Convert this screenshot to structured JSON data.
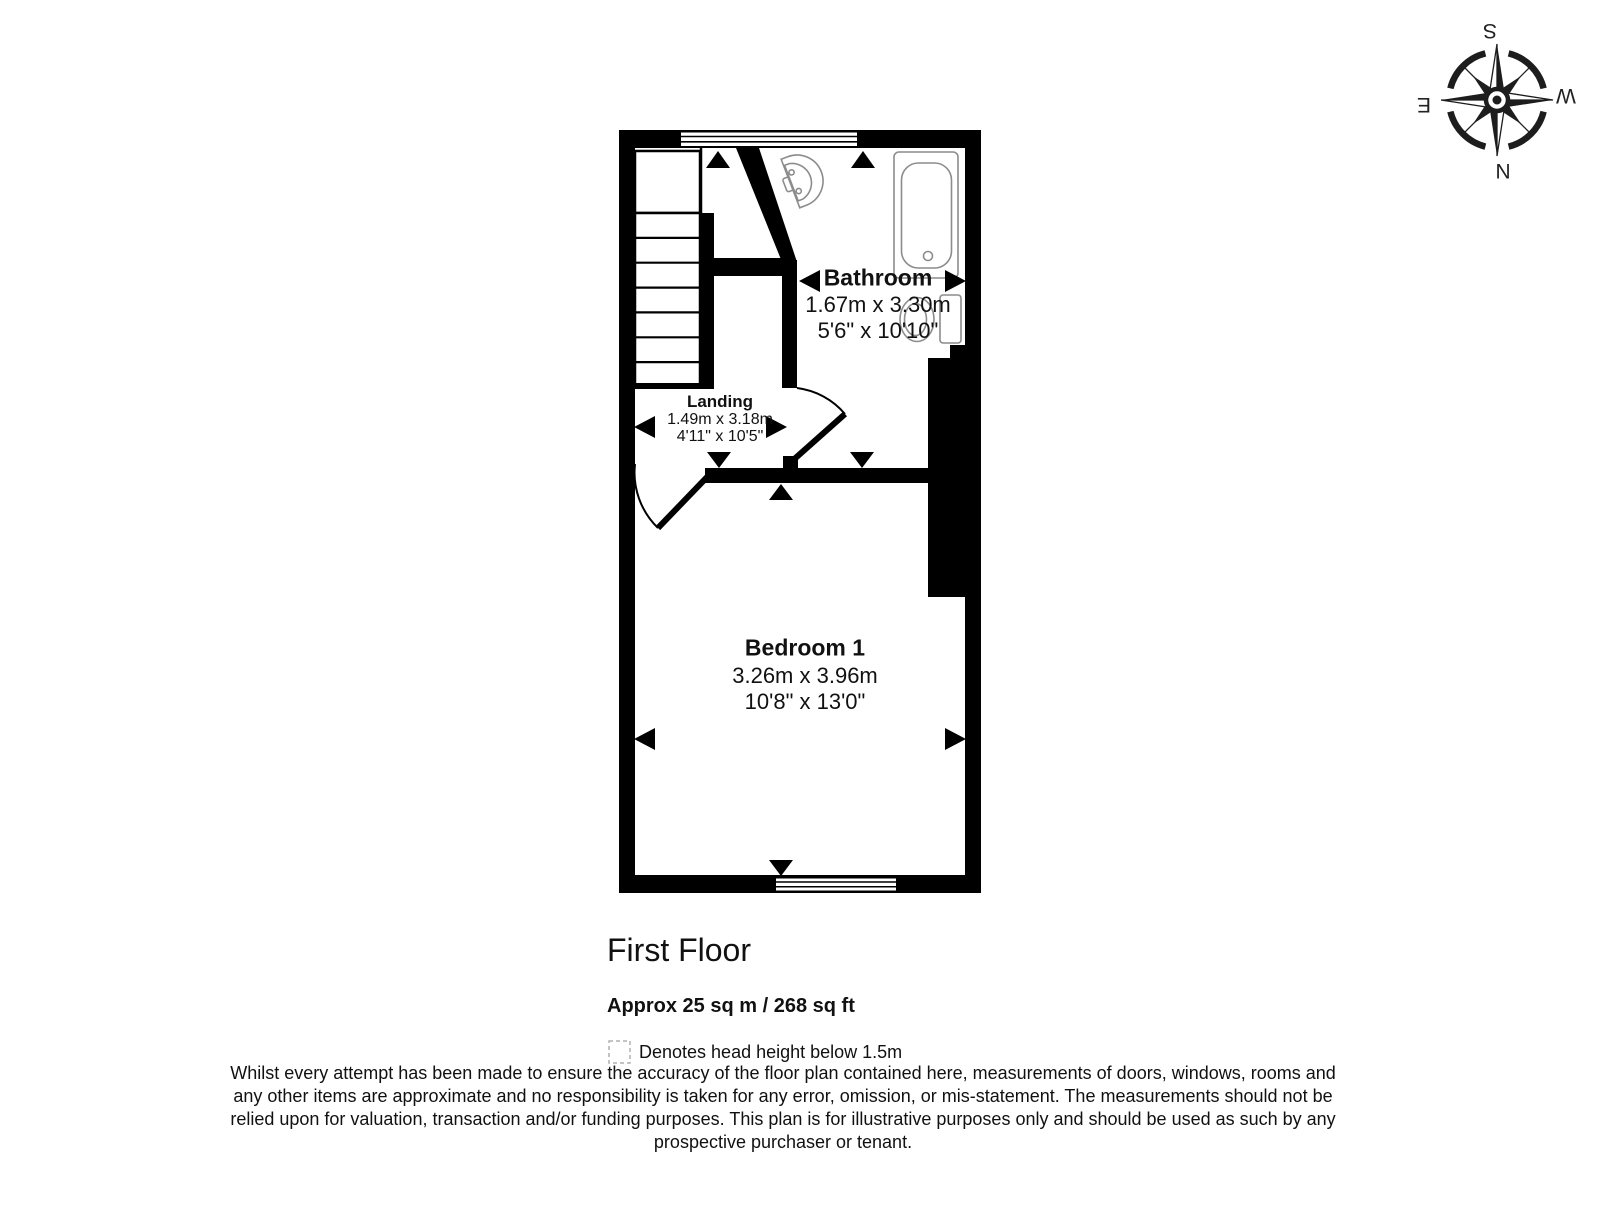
{
  "compass": {
    "top": "S",
    "bottom": "N",
    "left": "E",
    "right": "W"
  },
  "rooms": {
    "bathroom": {
      "name": "Bathroom",
      "metric": "1.67m x 3.30m",
      "imperial": "5'6\" x 10'10\""
    },
    "landing": {
      "name": "Landing",
      "metric": "1.49m x 3.18m",
      "imperial": "4'11\" x 10'5\""
    },
    "bedroom": {
      "name": "Bedroom 1",
      "metric": "3.26m x 3.96m",
      "imperial": "10'8\" x 13'0\""
    }
  },
  "floor": {
    "title": "First Floor",
    "area": "Approx 25 sq m / 268 sq ft"
  },
  "legend": {
    "label": "Denotes head height below 1.5m"
  },
  "disclaimer": {
    "lines": [
      "Whilst every attempt has been made to ensure the accuracy of the floor plan contained here, measurements of doors, windows, rooms and",
      "any other items are approximate and no responsibility is taken for any error, omission, or mis-statement. The measurements should not be",
      "relied upon for valuation, transaction and/or funding purposes. This plan is for illustrative purposes only and should be used as such by any",
      "prospective purchaser or tenant."
    ]
  },
  "colors": {
    "wall": "#000000",
    "fixture": "#8c8c8c",
    "text": "#111111"
  }
}
